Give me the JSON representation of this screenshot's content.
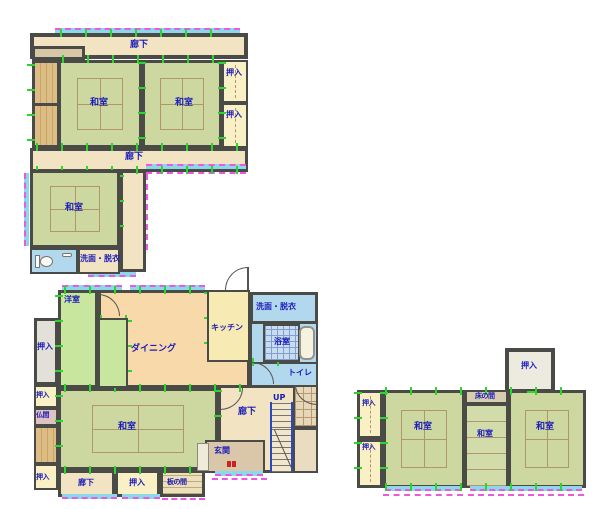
{
  "glossary": {
    "washitsu": "和室",
    "oshiire": "押入",
    "rouka": "廊下",
    "senmen_datsui": "洗面・脱衣",
    "youshitsu": "洋室",
    "dining": "ダイニング",
    "kitchen": "キッチン",
    "yokushitsu": "浴室",
    "toilet": "トイレ",
    "butsuma": "仏間",
    "genkan": "玄関",
    "itanoma": "板の間",
    "tokonoma": "床の間",
    "up": "UP"
  },
  "colors": {
    "wall": "#4a4a46",
    "tatami_green": "#cdd7a0",
    "corridor_cream": "#f2e4c3",
    "closet_yellow": "#faf0c6",
    "wood_tan": "#d7b27c",
    "dining_peach": "#f8d9a9",
    "kitchen_yellow": "#f7eab2",
    "western_green": "#c8e69e",
    "wet_blue": "#b2d8ee",
    "label_blue": "#1b1bb8",
    "window_cyan": "#8ad8ea",
    "dash_magenta": "#e85ae0",
    "tick_green": "#2ed52e",
    "butsuma_pink": "#dfc3c3",
    "stair_rail_blue": "#2a48c0",
    "stamp_red": "#cc2222"
  }
}
